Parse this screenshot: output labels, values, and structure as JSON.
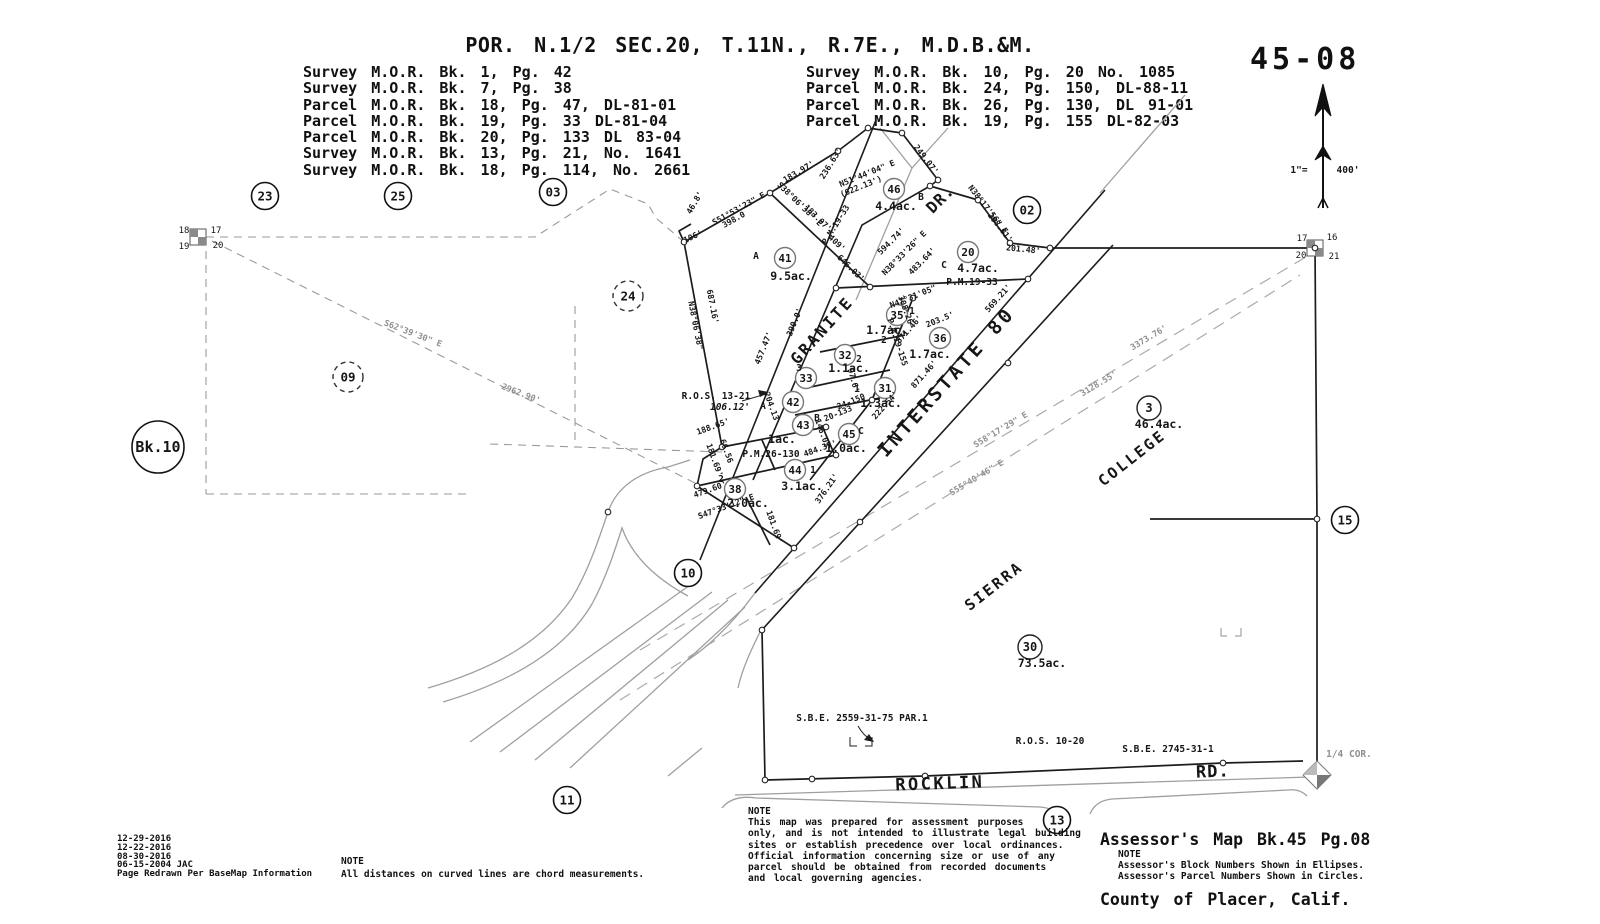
{
  "header": {
    "title": "POR. N.1/2 SEC.20, T.11N., R.7E., M.D.B.&M.",
    "map_number": "45-08",
    "surveys_left": [
      "Survey M.O.R. Bk. 1, Pg. 42",
      "Survey M.O.R. Bk. 7, Pg. 38",
      "Parcel M.O.R. Bk. 18, Pg. 47, DL-81-01",
      "Parcel M.O.R. Bk. 19, Pg. 33 DL-81-04",
      "Parcel M.O.R. Bk. 20, Pg. 133 DL 83-04",
      "Survey M.O.R. Bk. 13, Pg. 21, No. 1641",
      "Survey M.O.R. Bk. 18, Pg. 114, No. 2661"
    ],
    "surveys_right": [
      "Survey M.O.R. Bk. 10, Pg. 20 No. 1085",
      "Parcel M.O.R. Bk. 24, Pg. 150, DL-88-11",
      "Parcel M.O.R. Bk. 26, Pg. 130, DL 91-01",
      "Parcel M.O.R. Bk. 19, Pg. 155 DL-82-03"
    ]
  },
  "footer": {
    "revision_dates": [
      "12-29-2016",
      "12-22-2016",
      "08-30-2016",
      "06-15-2004 JAC",
      "Page Redrawn Per BaseMap Information"
    ],
    "note_curved_title": "NOTE",
    "note_curved_body": "All distances on curved lines are chord measurements.",
    "note_center_title": "NOTE",
    "note_center_lines": [
      "This map was prepared for assessment purposes",
      "only, and is not intended to illustrate legal building",
      "sites or establish precedence over local ordinances.",
      "Official information concerning size or use of any",
      "parcel should be obtained from recorded documents",
      "and local governing agencies."
    ],
    "map_title_line1": "Assessor's Map Bk.45 Pg.08",
    "map_title_line2": "County of Placer, Calif.",
    "note_numbers_title": "NOTE",
    "note_numbers_lines": [
      "Assessor's Block Numbers Shown in Ellipses.",
      "Assessor's Parcel Numbers Shown in Circles."
    ]
  },
  "map": {
    "sections": [
      {
        "n": "23",
        "x": 265,
        "y": 196
      },
      {
        "n": "25",
        "x": 398,
        "y": 196
      },
      {
        "n": "03",
        "x": 553,
        "y": 192
      },
      {
        "n": "02",
        "x": 1027,
        "y": 210
      },
      {
        "n": "10",
        "x": 688,
        "y": 573
      },
      {
        "n": "11",
        "x": 567,
        "y": 800
      },
      {
        "n": "13",
        "x": 1057,
        "y": 820
      },
      {
        "n": "15",
        "x": 1345,
        "y": 520
      }
    ],
    "sections_dashed": [
      {
        "n": "24",
        "x": 628,
        "y": 296
      },
      {
        "n": "09",
        "x": 348,
        "y": 377
      }
    ],
    "bk_circle": {
      "t": "Bk.10",
      "x": 158,
      "y": 447
    },
    "parcels": [
      {
        "n": "41",
        "x": 785,
        "y": 258,
        "ac": "9.5ac.",
        "ax": 791,
        "ay": 280
      },
      {
        "n": "46",
        "x": 894,
        "y": 189,
        "ac": "4.4ac.",
        "ax": 896,
        "ay": 210
      },
      {
        "n": "20",
        "x": 968,
        "y": 252,
        "ac": "4.7ac.",
        "ax": 978,
        "ay": 272
      },
      {
        "n": "35",
        "x": 897,
        "y": 315,
        "ac": "1.7ac.",
        "ax": 887,
        "ay": 334
      },
      {
        "n": "36",
        "x": 940,
        "y": 338,
        "ac": "1.7ac.",
        "ax": 930,
        "ay": 358
      },
      {
        "n": "32",
        "x": 845,
        "y": 355,
        "ac": "1.1ac.",
        "ax": 849,
        "ay": 372
      },
      {
        "n": "33",
        "x": 806,
        "y": 378
      },
      {
        "n": "31",
        "x": 885,
        "y": 388,
        "ac": "1.3ac.",
        "ax": 881,
        "ay": 407
      },
      {
        "n": "42",
        "x": 793,
        "y": 402
      },
      {
        "n": "43",
        "x": 803,
        "y": 425,
        "ac": "1ac.",
        "ax": 782,
        "ay": 443
      },
      {
        "n": "45",
        "x": 849,
        "y": 434,
        "ac": "1.0ac.",
        "ax": 846,
        "ay": 452
      },
      {
        "n": "44",
        "x": 795,
        "y": 470,
        "ac": "3.1ac.",
        "ax": 802,
        "ay": 490
      },
      {
        "n": "38",
        "x": 735,
        "y": 489,
        "ac": "2.0ac.",
        "ax": 748,
        "ay": 507
      },
      {
        "n": "3",
        "x": 1149,
        "y": 408,
        "ac": "46.4ac.",
        "ax": 1159,
        "ay": 428,
        "k": "s"
      },
      {
        "n": "30",
        "x": 1030,
        "y": 647,
        "ac": "73.5ac.",
        "ax": 1042,
        "ay": 667,
        "k": "s"
      }
    ],
    "subs": [
      {
        "t": "A",
        "x": 756,
        "y": 259
      },
      {
        "t": "B",
        "x": 921,
        "y": 200
      },
      {
        "t": "C",
        "x": 944,
        "y": 268
      },
      {
        "t": "1",
        "x": 912,
        "y": 314
      },
      {
        "t": "2",
        "x": 884,
        "y": 343
      },
      {
        "t": "2",
        "x": 859,
        "y": 362
      },
      {
        "t": "3",
        "x": 799,
        "y": 371
      },
      {
        "t": "1",
        "x": 857,
        "y": 392
      },
      {
        "t": "A",
        "x": 763,
        "y": 409
      },
      {
        "t": "B",
        "x": 817,
        "y": 421
      },
      {
        "t": "C",
        "x": 861,
        "y": 434
      },
      {
        "t": "1",
        "x": 813,
        "y": 473
      },
      {
        "t": "2",
        "x": 721,
        "y": 482
      }
    ],
    "streets": [
      {
        "t": "GRANITE",
        "x": 826,
        "y": 334,
        "r": -48,
        "s": 16,
        "ls": 2.5
      },
      {
        "t": "DR.",
        "x": 944,
        "y": 203,
        "r": -45,
        "s": 16,
        "ls": 1
      },
      {
        "t": "INTERSTATE 80",
        "x": 951,
        "y": 386,
        "r": -48,
        "s": 19,
        "ls": 3.5
      },
      {
        "t": "SIERRA",
        "x": 997,
        "y": 590,
        "r": -38,
        "s": 15,
        "ls": 2.5
      },
      {
        "t": "COLLEGE",
        "x": 1135,
        "y": 462,
        "r": -38,
        "s": 15,
        "ls": 2.5
      },
      {
        "t": "ROCKLIN",
        "x": 940,
        "y": 789,
        "r": -2,
        "s": 17,
        "ls": 2.5
      },
      {
        "t": "RD.",
        "x": 1213,
        "y": 777,
        "r": -2,
        "s": 17,
        "ls": 1
      }
    ],
    "refs": [
      {
        "t": "R.O.S. 13-21",
        "x": 716,
        "y": 399
      },
      {
        "t": "106.12'",
        "x": 730,
        "y": 410,
        "i": 1
      },
      {
        "t": "P.M.26-130",
        "x": 771,
        "y": 457
      },
      {
        "t": "P.M.19-33",
        "x": 972,
        "y": 285
      },
      {
        "t": "S.B.E. 2559-31-75 PAR.1",
        "x": 862,
        "y": 721
      },
      {
        "t": "R.O.S. 10-20",
        "x": 1050,
        "y": 744
      },
      {
        "t": "S.B.E. 2745-31-1",
        "x": 1168,
        "y": 752
      },
      {
        "t": "1/4 COR.",
        "x": 1349,
        "y": 757,
        "g": 1
      },
      {
        "t": "1\"=",
        "x": 1299,
        "y": 173
      },
      {
        "t": "400'",
        "x": 1348,
        "y": 173
      }
    ],
    "corner_labels": [
      {
        "t": "18",
        "x": 184,
        "y": 233
      },
      {
        "t": "17",
        "x": 216,
        "y": 233
      },
      {
        "t": "19",
        "x": 184,
        "y": 249
      },
      {
        "t": "20",
        "x": 218,
        "y": 248
      },
      {
        "t": "17",
        "x": 1302,
        "y": 241
      },
      {
        "t": "16",
        "x": 1332,
        "y": 240
      },
      {
        "t": "20",
        "x": 1301,
        "y": 258
      },
      {
        "t": "21",
        "x": 1334,
        "y": 259
      }
    ],
    "bearings": [
      {
        "t": "S62°39'30\" E",
        "x": 412,
        "y": 336,
        "r": 21,
        "g": 1
      },
      {
        "t": "2962.90'",
        "x": 520,
        "y": 396,
        "r": 21,
        "g": 1
      },
      {
        "t": "3373.76'",
        "x": 1150,
        "y": 340,
        "r": -31,
        "g": 1
      },
      {
        "t": "3128.55'",
        "x": 1100,
        "y": 386,
        "r": -31,
        "g": 1
      },
      {
        "t": "S58°17'29\" E",
        "x": 1002,
        "y": 432,
        "r": -31,
        "g": 1
      },
      {
        "t": "S55°40'46\" E",
        "x": 978,
        "y": 480,
        "r": -31,
        "g": 1
      },
      {
        "t": "S51°53'23\" E",
        "x": 740,
        "y": 211,
        "r": -29
      },
      {
        "t": "398.0",
        "x": 735,
        "y": 222,
        "r": -29
      },
      {
        "t": "46.8'",
        "x": 697,
        "y": 204,
        "r": -60
      },
      {
        "t": "106'",
        "x": 694,
        "y": 239,
        "r": -25
      },
      {
        "t": "N38°06'38\"",
        "x": 693,
        "y": 326,
        "r": 79
      },
      {
        "t": "687.16'",
        "x": 710,
        "y": 307,
        "r": 79
      },
      {
        "t": "183.97'",
        "x": 800,
        "y": 174,
        "r": -31
      },
      {
        "t": "236.63'",
        "x": 833,
        "y": 165,
        "r": -58
      },
      {
        "t": "N51°44'04\" E",
        "x": 868,
        "y": 176,
        "r": -22
      },
      {
        "t": "(622.13')",
        "x": 862,
        "y": 189,
        "r": -22
      },
      {
        "t": "249.07'",
        "x": 924,
        "y": 161,
        "r": 52
      },
      {
        "t": "P.M.19-33",
        "x": 838,
        "y": 226,
        "r": -58
      },
      {
        "t": "S38°06'38\" E",
        "x": 798,
        "y": 206,
        "r": 44
      },
      {
        "t": "183.97'",
        "x": 816,
        "y": 220,
        "r": 44
      },
      {
        "t": "409'",
        "x": 835,
        "y": 245,
        "r": 44
      },
      {
        "t": "646.03'",
        "x": 849,
        "y": 270,
        "r": 44
      },
      {
        "t": "390.0'",
        "x": 797,
        "y": 323,
        "r": -68
      },
      {
        "t": "457.47'",
        "x": 766,
        "y": 349,
        "r": -68
      },
      {
        "t": "594.74'",
        "x": 893,
        "y": 243,
        "r": -45
      },
      {
        "t": "N38°33'26\" E",
        "x": 906,
        "y": 255,
        "r": -45
      },
      {
        "t": "483.64'",
        "x": 924,
        "y": 263,
        "r": -45
      },
      {
        "t": "N38°17'56\" E",
        "x": 986,
        "y": 211,
        "r": 52
      },
      {
        "t": "298.61'",
        "x": 998,
        "y": 229,
        "r": 52
      },
      {
        "t": "201.48'",
        "x": 1023,
        "y": 252,
        "r": 6
      },
      {
        "t": "569.21'",
        "x": 1000,
        "y": 300,
        "r": -48
      },
      {
        "t": "N47°31'05\"",
        "x": 914,
        "y": 299,
        "r": -22
      },
      {
        "t": "308.26'",
        "x": 904,
        "y": 313,
        "r": 70
      },
      {
        "t": "P.M.19-155",
        "x": 895,
        "y": 343,
        "r": 72
      },
      {
        "t": "203.5'",
        "x": 941,
        "y": 322,
        "r": -22
      },
      {
        "t": "871.46'",
        "x": 911,
        "y": 331,
        "r": -48
      },
      {
        "t": "871.46'",
        "x": 926,
        "y": 376,
        "r": -48
      },
      {
        "t": "97.6'",
        "x": 851,
        "y": 381,
        "r": 75
      },
      {
        "t": "24-150",
        "x": 852,
        "y": 404,
        "r": -22
      },
      {
        "t": "20-133",
        "x": 839,
        "y": 416,
        "r": -22
      },
      {
        "t": "222.54'",
        "x": 887,
        "y": 407,
        "r": -48
      },
      {
        "t": "204.13",
        "x": 769,
        "y": 407,
        "r": 70
      },
      {
        "t": "188.65'",
        "x": 714,
        "y": 429,
        "r": -20
      },
      {
        "t": "146.03",
        "x": 820,
        "y": 434,
        "r": 70
      },
      {
        "t": "484.37'",
        "x": 821,
        "y": 451,
        "r": -20
      },
      {
        "t": "376.21'",
        "x": 829,
        "y": 490,
        "r": -55
      },
      {
        "t": "479.60'",
        "x": 711,
        "y": 492,
        "r": -20
      },
      {
        "t": "S47°33'12\" E",
        "x": 727,
        "y": 509,
        "r": -20
      },
      {
        "t": "181.69'",
        "x": 772,
        "y": 528,
        "r": 70
      },
      {
        "t": "181.69'",
        "x": 712,
        "y": 461,
        "r": 70
      },
      {
        "t": "66.56",
        "x": 724,
        "y": 452,
        "r": 70
      }
    ]
  }
}
